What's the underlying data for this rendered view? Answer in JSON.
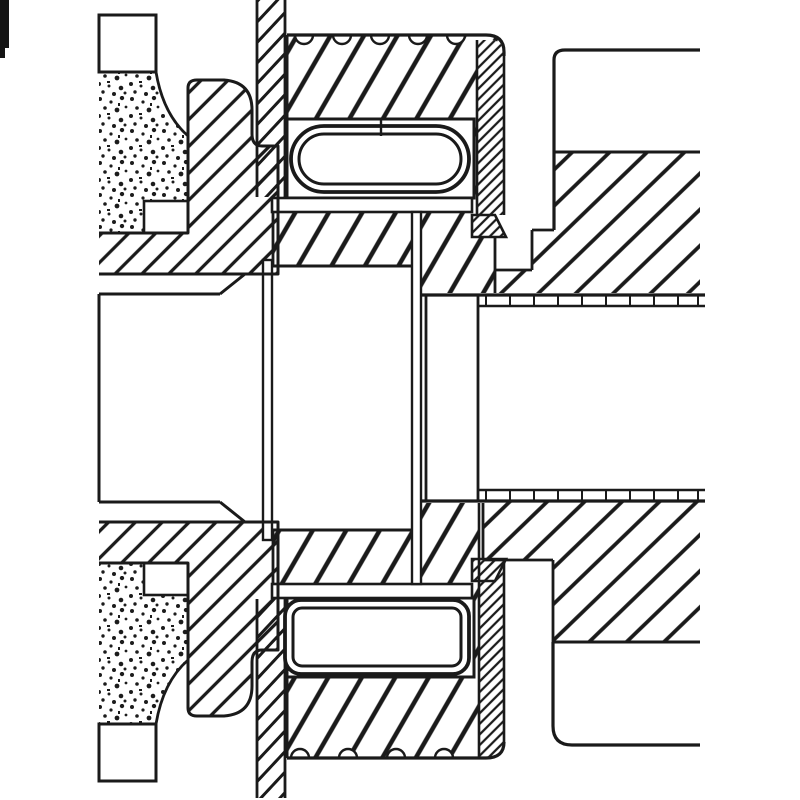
{
  "meta": {
    "aria_label": "Black and white sectional engineering drawing of a mechanical coupling assembly with rollers, hatched cut surfaces, threads and a stippled collar",
    "drawing_type": "technical-cross-section"
  },
  "palette": {
    "ink": "#1a1a1a",
    "paper": "#ffffff"
  },
  "components": [
    {
      "name": "left-knurled-collar",
      "texture": "stipple"
    },
    {
      "name": "left-flange",
      "texture": "hatch-45"
    },
    {
      "name": "center-gland-sleeve",
      "texture": "hatch-steep"
    },
    {
      "name": "sleeve-lip",
      "texture": "hatch-fine-45"
    },
    {
      "name": "top-roller",
      "shape": "stadium"
    },
    {
      "name": "bottom-roller",
      "shape": "rounded-rect"
    },
    {
      "name": "retainer-strip-top",
      "texture": "hatch-dense"
    },
    {
      "name": "retainer-strip-bottom",
      "texture": "hatch-dense"
    },
    {
      "name": "right-body",
      "texture": "hatch-45"
    },
    {
      "name": "right-body-face",
      "texture": "plain"
    },
    {
      "name": "thread-interface-top",
      "feature": "double-line-with-ticks"
    },
    {
      "name": "thread-interface-bottom",
      "feature": "double-line-with-ticks"
    },
    {
      "name": "thread-crests-top",
      "feature": "semicircle-notches"
    },
    {
      "name": "thread-crests-bottom",
      "feature": "semicircle-notches"
    },
    {
      "name": "central-bore",
      "texture": "white"
    },
    {
      "name": "scan-artifact",
      "texture": "black-mark"
    }
  ]
}
